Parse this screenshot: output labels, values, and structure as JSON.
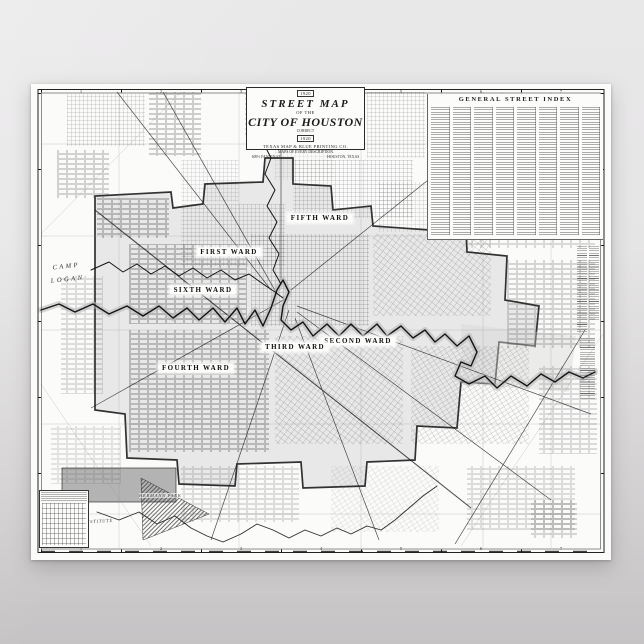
{
  "colors": {
    "backdrop_top": "#e9e8e9",
    "backdrop_bottom": "#c4c2c3",
    "paper": "#fbfbfa",
    "ink": "#1c1c1c",
    "city_shading": "#d6d6d6"
  },
  "poster": {
    "cartouche": {
      "year_small": "1920",
      "title_line1": "STREET MAP",
      "title_line2": "OF THE",
      "title_line3": "CITY OF HOUSTON",
      "note": "CORRECT",
      "year": "1920",
      "publisher": "TEXAS MAP & BLUE PRINTING CO.",
      "tagline": "MAPS OF EVERY DESCRIPTION",
      "address": "609½ FANNIN ST.",
      "city": "HOUSTON, TEXAS"
    },
    "street_index": {
      "title": "GENERAL STREET INDEX",
      "column_count": 8
    },
    "wards": [
      {
        "label": "FIFTH WARD"
      },
      {
        "label": "FIRST WARD"
      },
      {
        "label": "SIXTH WARD"
      },
      {
        "label": "SECOND WARD"
      },
      {
        "label": "THIRD WARD"
      },
      {
        "label": "FOURTH WARD"
      }
    ],
    "place_labels": {
      "camp_line1": "CAMP",
      "camp_line2": "LOGAN",
      "park": "HERMANN PARK",
      "institute": "RICE INSTITUTE"
    },
    "border_section_numbers": [
      "1",
      "2",
      "3",
      "4",
      "5",
      "6",
      "7"
    ]
  }
}
